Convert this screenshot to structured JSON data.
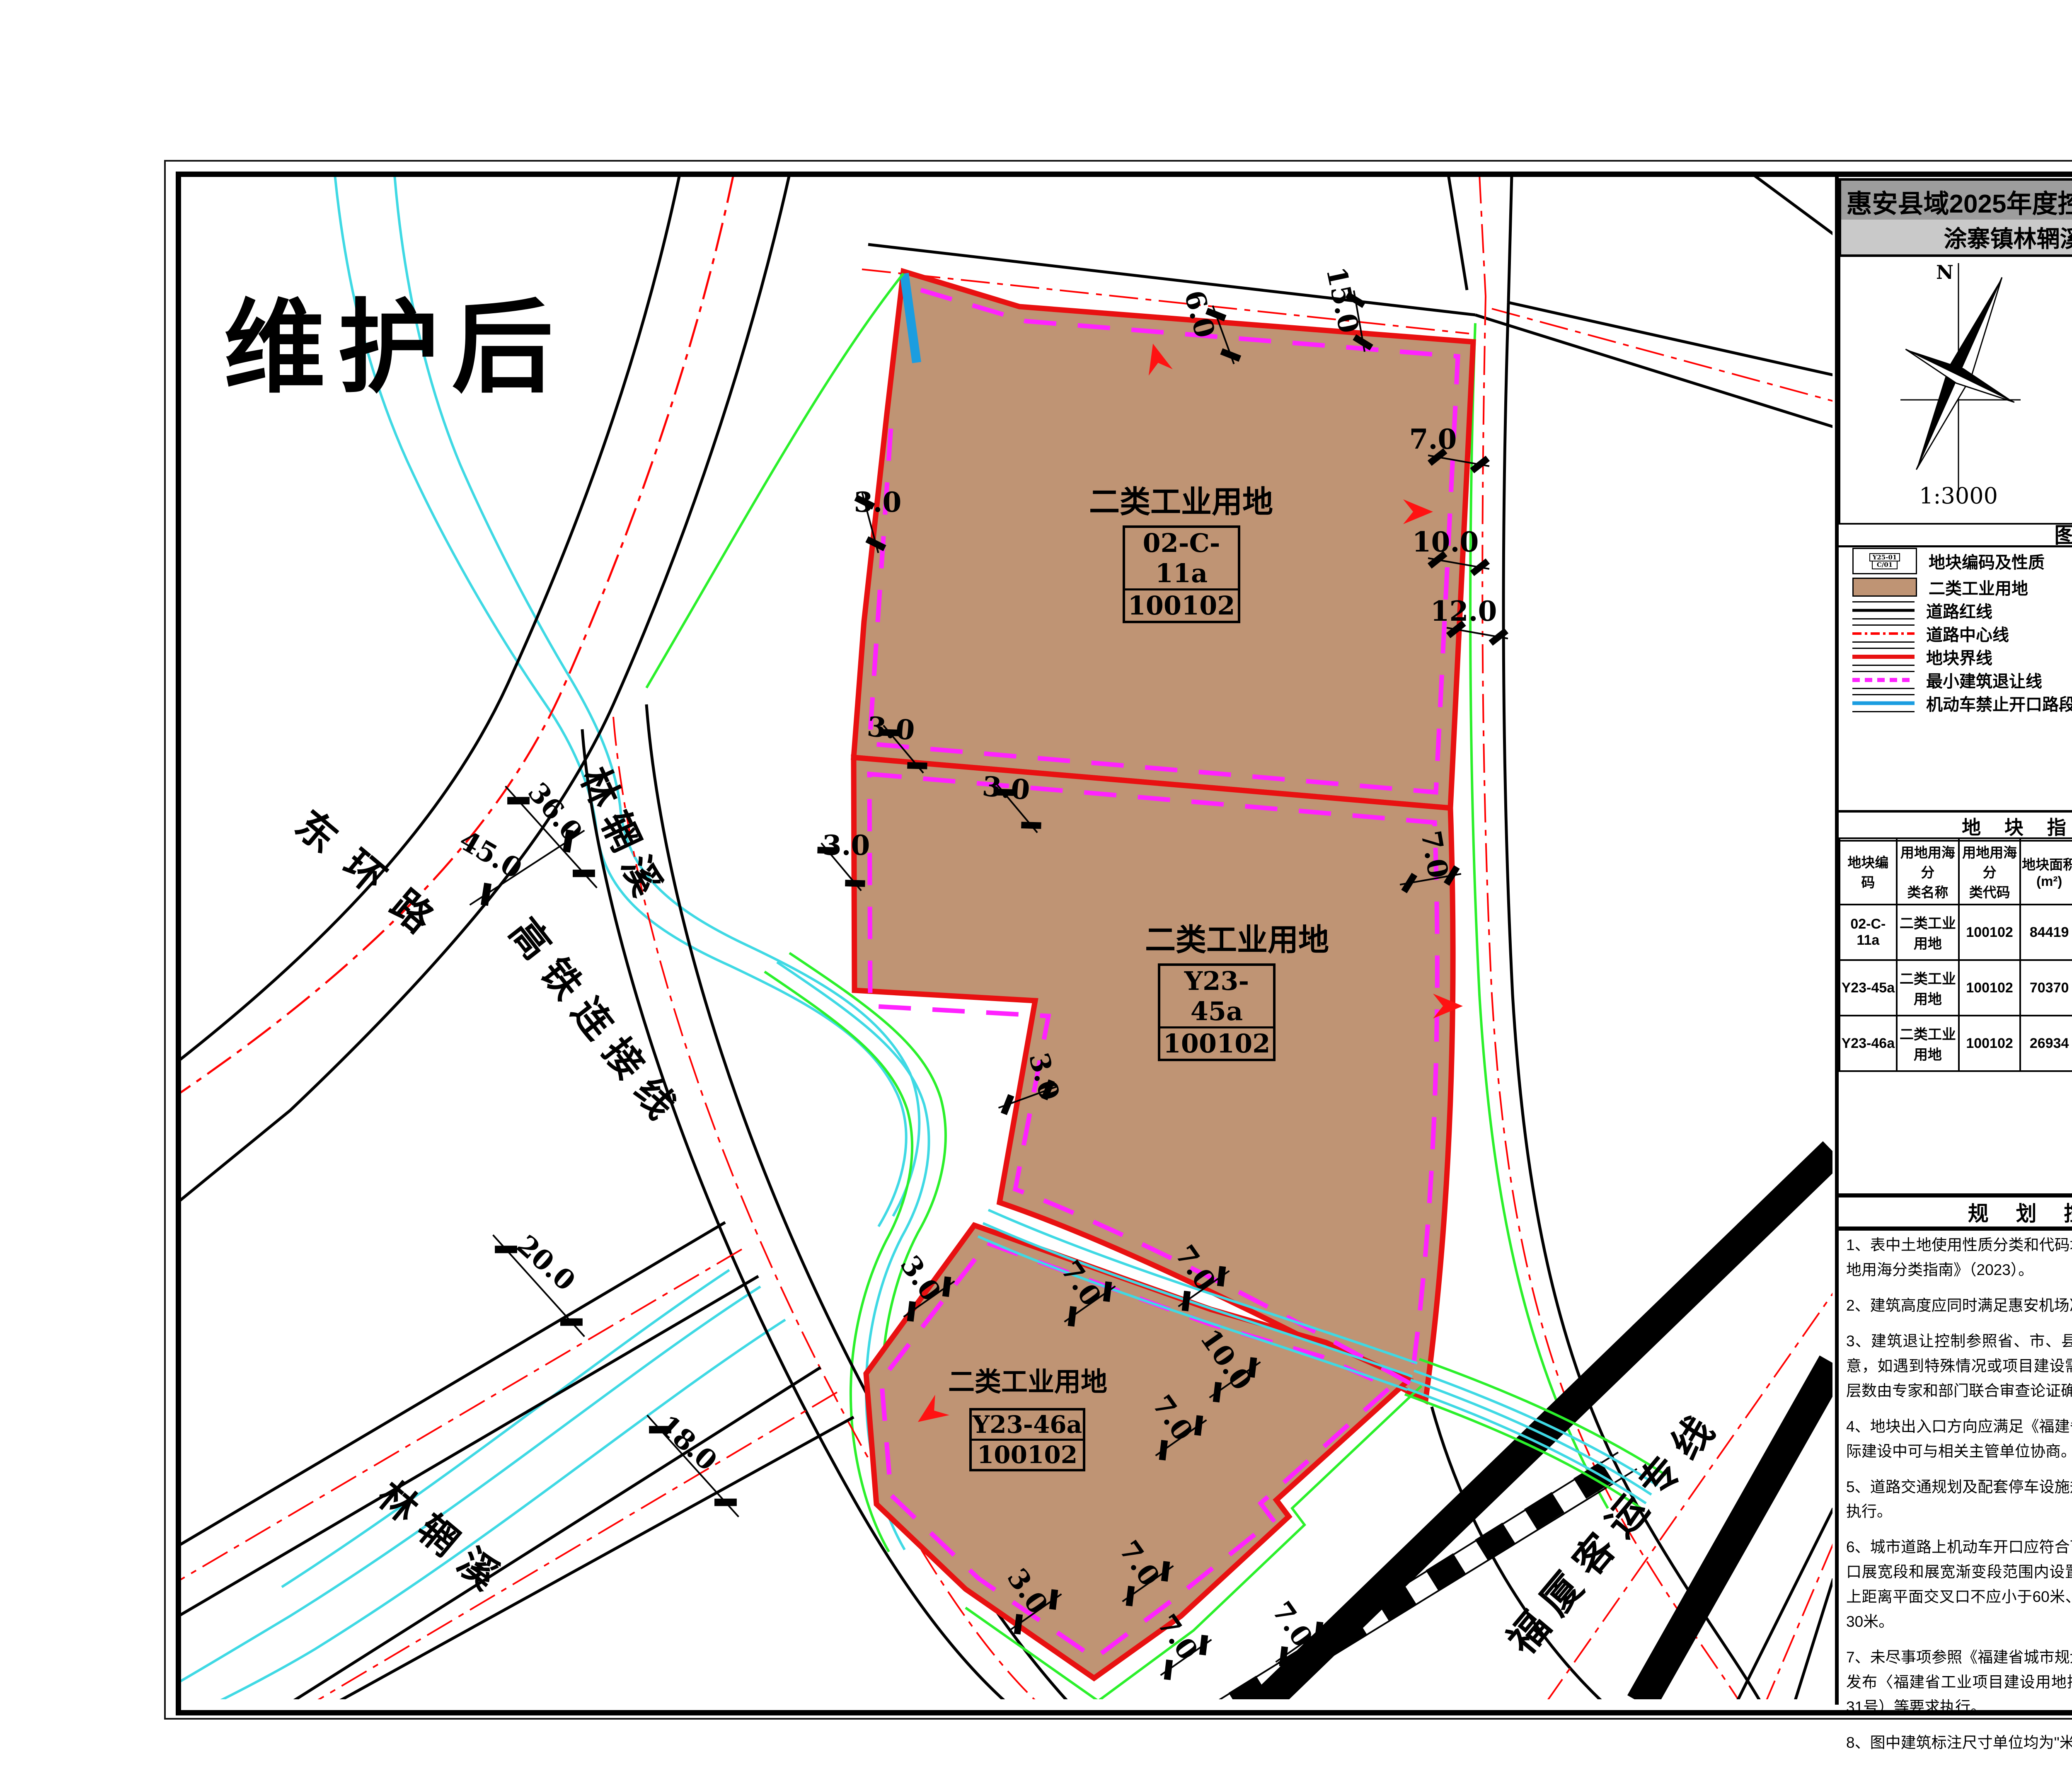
{
  "page": {
    "state_label": "维护后"
  },
  "header": {
    "title1": "惠安县域2025年度控规动态维护（第三批次）",
    "title2": "涂寨镇林辋溪东侧地块规划图则"
  },
  "compass": {
    "north_label": "N",
    "scale_label": "1:3000"
  },
  "inset": {
    "caption": "位置示意"
  },
  "legend": {
    "title": "图  例",
    "left_items": [
      {
        "label": "地块编码及性质",
        "sym_top": "Y25-01",
        "sym_bottom": "C/01"
      },
      {
        "label": "二类工业用地"
      },
      {
        "label": "道路红线"
      },
      {
        "label": "道路中心线"
      },
      {
        "label": "地块界线"
      },
      {
        "label": "最小建筑退让线"
      },
      {
        "label": "机动车禁止开口路段"
      }
    ],
    "right_items": [
      {
        "label": "界点坐标",
        "sym_x": "X=2727850.785",
        "sym_y": "Y=503901.803"
      },
      {
        "label": "转弯半径标注",
        "sym": "R20"
      },
      {
        "label": "尺寸标注",
        "sym": "10.0"
      },
      {
        "label": "机动车出入口",
        "sym": "▲"
      },
      {
        "label": "规划标高",
        "sym": "29.00"
      },
      {
        "label": "坡度、坡向",
        "sym_top": "1.0%",
        "sym_bottom": "200.00"
      }
    ],
    "colors": {
      "industrial": "#bf9474",
      "boundary": "#e81111",
      "setback": "#ff22ff",
      "no_opening": "#1b9de0",
      "centerline": "#ff0000"
    }
  },
  "table": {
    "title": "地 块 指 标 一 览 表",
    "headers": [
      "地块编码",
      "用地用海分\n类名称",
      "用地用海分\n类代码",
      "地块面积\n(m²)",
      "容积率",
      "建筑系数\n(%)",
      "建筑限高\n(m)",
      "绿地率\n(%)",
      "出入口\n方向"
    ],
    "rows": [
      [
        "02-C-11a",
        "二类工业\n用地",
        "100102",
        "84419",
        "1.2-3.0",
        "≥40",
        "≤50",
        "10-20",
        "N/E"
      ],
      [
        "Y23-45a",
        "二类工业\n用地",
        "100102",
        "70370",
        "1.1-3.0",
        "≥40",
        "≤50",
        "—",
        "E"
      ],
      [
        "Y23-46a",
        "二类工业\n用地",
        "100102",
        "26934",
        "1.1-3.0",
        "≥40",
        "≤50",
        "—",
        "S"
      ]
    ]
  },
  "provisions": {
    "title": "规 划 控 制 条 文",
    "items": [
      "1、表中土地使用性质分类和代码均采用《国土空间调查、规划、用途管制用地用海分类指南》（2023）。",
      "2、建筑高度应同时满足惠安机场净空保护要求。",
      "3、建筑退让控制参照省、市、县相关技术规定执行，图则中建筑退线为示意，如遇到特殊情况或项目建设需要，实际后退线结合道路、临用地的建筑层数由专家和部门联合审查论证确定。",
      "4、地块出入口方向应满足《福建省城市规划管理技术规定》的相关规定，实际建设中可与相关主管单位协商。",
      "5、道路交通规划及配套停车设施规划参照《福建省城市规划管理技术规定》执行。",
      "6、城市道路上机动车开口应符合下列规定：交叉口有展宽段时，不得在交叉口展宽段和展宽渐变段范围内设置机动车开口；交叉口无展宽段时，主干路上距离平面交叉口不应小于60米、次干路上不应小于50米、支路上不宜小于30米。",
      "7、未尽事项参照《福建省城市规划管理技术规定》、《福建省自然资源厅关于发布〈福建省工业项目建设用地控制指标〉的通知》（闽自然资发〔2024〕31号）等要求执行。",
      "8、图中建筑标注尺寸单位均为\"米\"。"
    ]
  },
  "map": {
    "parcels": [
      {
        "use": "二类工业用地",
        "code": "02-C-11a",
        "class_code": "100102"
      },
      {
        "use": "二类工业用地",
        "code": "Y23-45a",
        "class_code": "100102"
      },
      {
        "use": "二类工业用地",
        "code": "Y23-46a",
        "class_code": "100102"
      }
    ],
    "road_labels": [
      "东环路",
      "高铁连接线",
      "福厦客运专线"
    ],
    "stream_labels": [
      "林辋溪",
      "林辋溪"
    ],
    "dims": [
      "36.0",
      "45.0",
      "20.0",
      "18.0",
      "3.0",
      "6.0",
      "15.0",
      "7.0",
      "10.0",
      "12.0",
      "3.0",
      "3.0",
      "3.0",
      "3.0",
      "7.0",
      "3.0",
      "7.0",
      "7.0",
      "10.0",
      "7.0",
      "3.0",
      "7.0",
      "7.0",
      "7.0"
    ]
  }
}
